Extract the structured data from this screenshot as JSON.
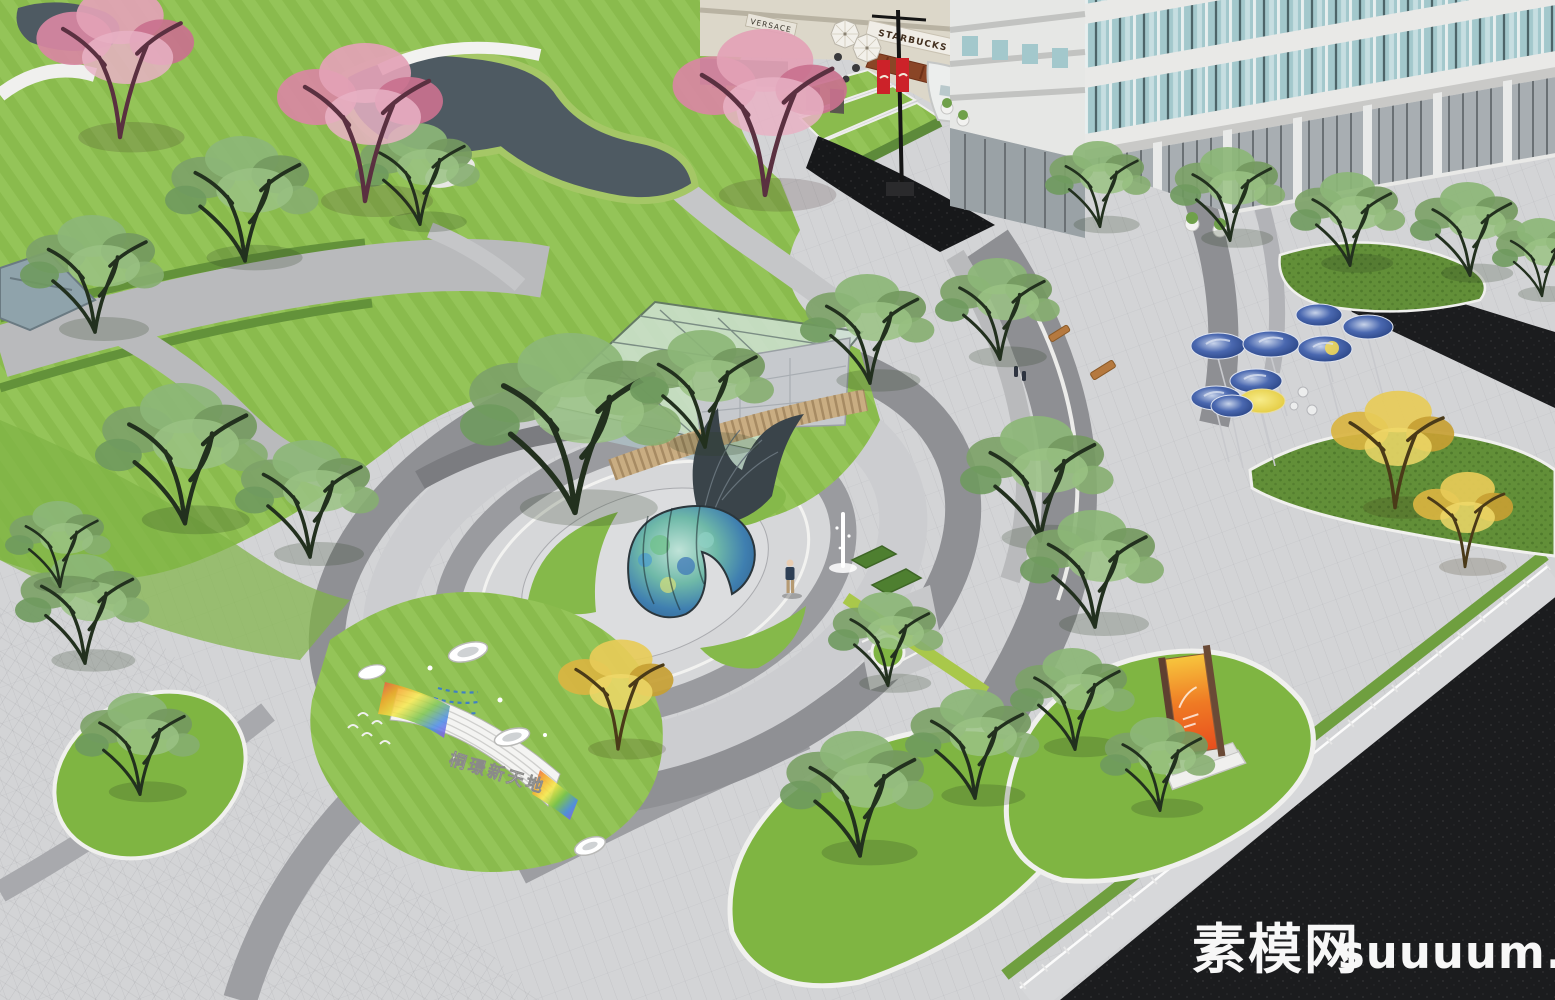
{
  "scene": {
    "type": "3D landscape architecture rendering",
    "view": "aerial oblique",
    "subject": "Commercial plaza park with curved lawns, whale sculptures, starry-night disc canopies, retail street and office tower"
  },
  "signs": {
    "storefront_left": "VERSACE",
    "storefront_right": "STARBUCKS",
    "plaza_sign_text": "桐璟新天地"
  },
  "watermark": {
    "site_name_cn": "素模网",
    "site_domain": "suuuum.com"
  },
  "palette": {
    "lawn_green": "#85b94a",
    "hedge_green": "#628f38",
    "tree_green": "#7da268",
    "blossom_pink": "#dd8fa8",
    "ginkgo_yellow": "#d9b441",
    "paving_light": "#d3d4d6",
    "paving_band": "#95969a",
    "asphalt_dark": "#1b1c1e",
    "water_dark": "#4e5a62",
    "disc_blue": "#2f4e92",
    "disc_yellow": "#e8d23e",
    "banner_red": "#cc2229",
    "awning_brown": "#8a4526",
    "billboard_orange": "#ef7a24"
  }
}
